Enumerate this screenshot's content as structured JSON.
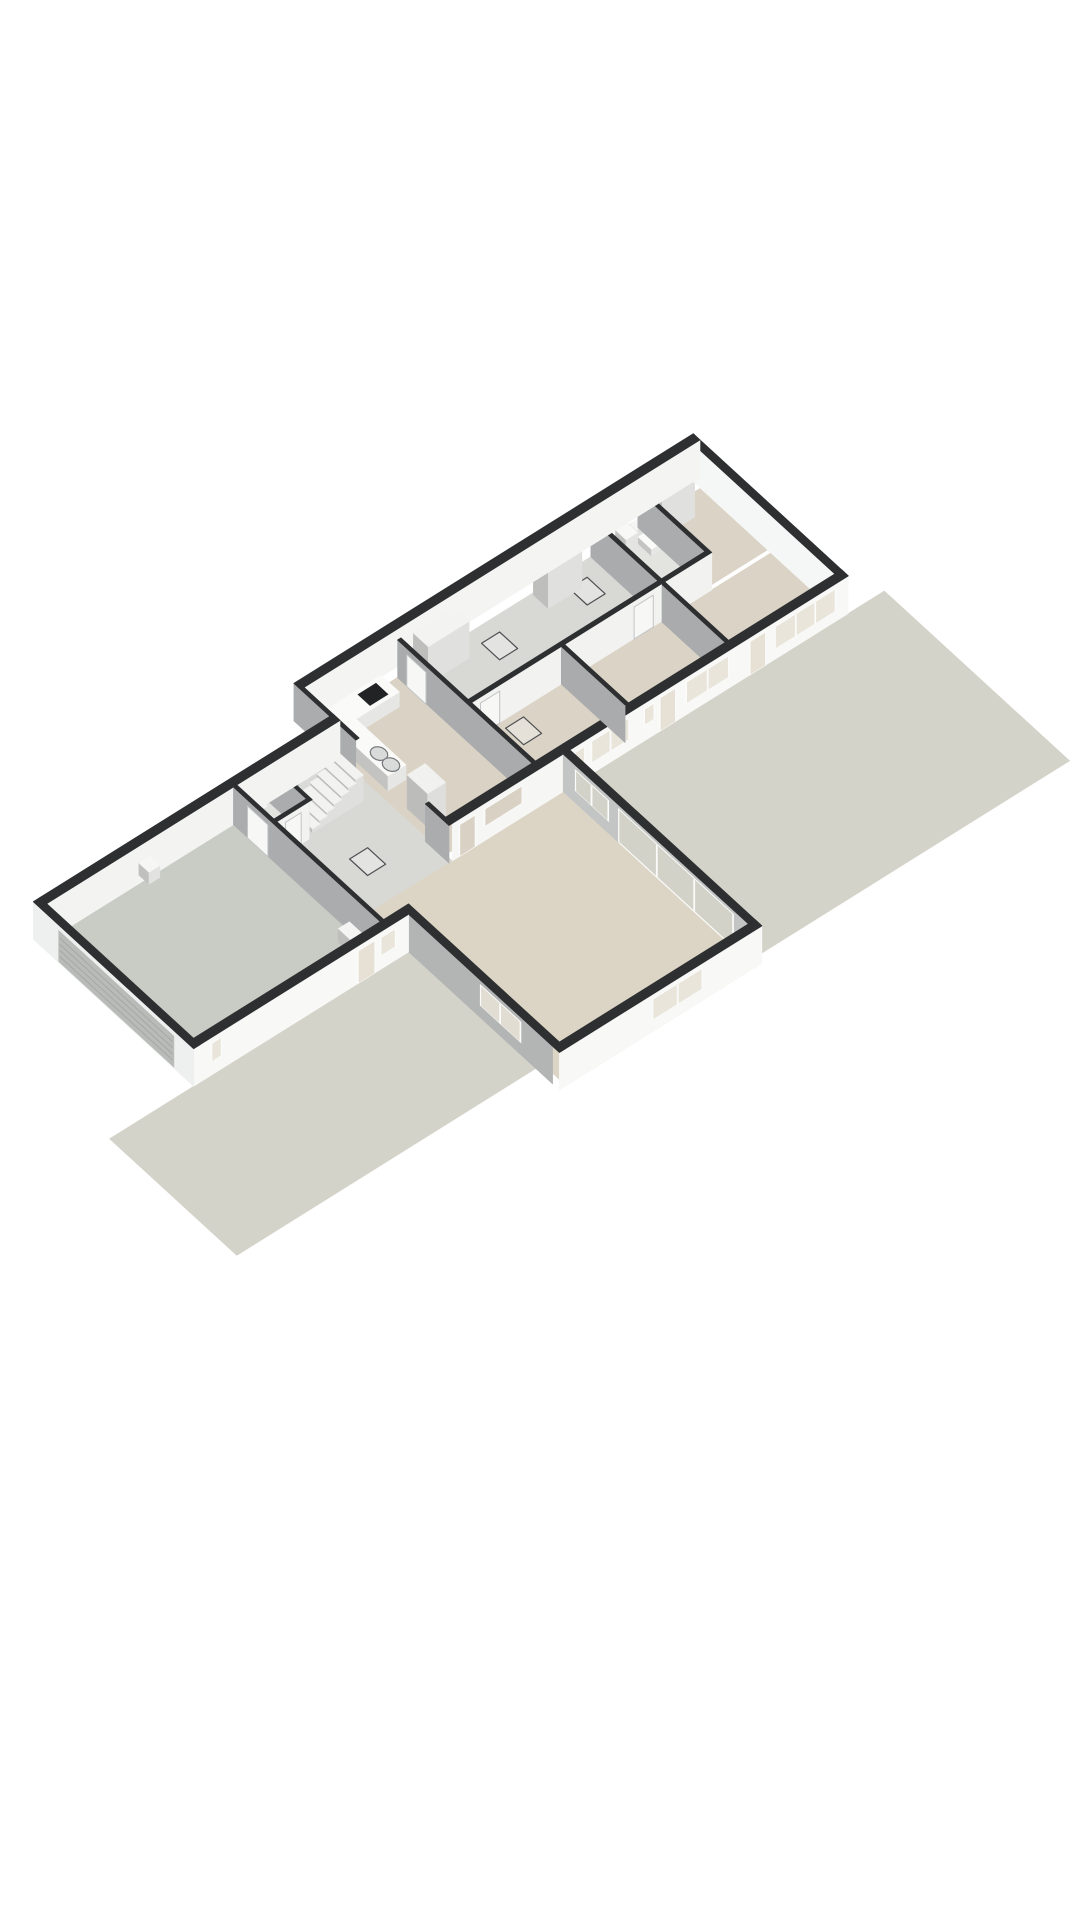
{
  "scene": {
    "projection": {
      "x0": 304,
      "y0": 725,
      "eu": [
        24,
        -15
      ],
      "ev": [
        24,
        22
      ],
      "ez": 16,
      "wall_height": 2.35
    },
    "palette": {
      "background": "#ffffff",
      "cap": "#2d2f31",
      "frame": "#fbfbfa",
      "glass_window": "#e9e5da",
      "glass_door": "#e7e0d4",
      "glass_terrace": "#d3d2c8",
      "garage_door": "#b8bbb8",
      "garage_door_line": "#a4a7a4",
      "hatch_stroke": "#4d4f52",
      "hatch_fill": "rgba(250,250,248,0.35)",
      "door_leaf": "#f7f7f6",
      "door_leaf_edge": "#c2c4c6",
      "bowl_fill": "#d9dada",
      "bowl_stroke": "#75777a"
    },
    "grounds": [
      {
        "name": "ground-terrace",
        "u1": 4.9,
        "v1": 6.18,
        "u2": 18.0,
        "v2": 13.9,
        "color": "#d4d3c9"
      },
      {
        "name": "ground-driveway",
        "u1": -16.0,
        "v1": 7.9,
        "u2": -3.54,
        "v2": 13.2,
        "color": "#d4d3c9"
      }
    ],
    "floors": [
      {
        "name": "floor-garage",
        "u1": -12.22,
        "v1": 1.5,
        "u2": -4.44,
        "v2": 7.62,
        "color": "#c9ccc5"
      },
      {
        "name": "floor-hall",
        "u1": -4.3,
        "v1": 1.5,
        "u2": 0,
        "v2": 7.62,
        "color": "#d8d8d4"
      },
      {
        "name": "floor-wc-hall",
        "u1": -4.3,
        "v1": 1.5,
        "u2": -2.95,
        "v2": 3.05,
        "color": "#e3e3df"
      },
      {
        "name": "floor-kitchen",
        "u1": 0,
        "v1": 0.3,
        "u2": 3.6,
        "v2": 5.9,
        "color": "#dad3c5"
      },
      {
        "name": "floor-corridor",
        "u1": 3.74,
        "v1": 0.3,
        "u2": 11.65,
        "v2": 3.1,
        "color": "#d8d8d4"
      },
      {
        "name": "floor-bedroom-3",
        "u1": 3.74,
        "v1": 3.24,
        "u2": 7.48,
        "v2": 5.9,
        "color": "#dbd4c6"
      },
      {
        "name": "floor-bedroom-2",
        "u1": 7.62,
        "v1": 3.24,
        "u2": 11.65,
        "v2": 5.9,
        "color": "#dbd4c6"
      },
      {
        "name": "floor-bathroom",
        "u1": 11.79,
        "v1": 0.3,
        "u2": 13.61,
        "v2": 3.1,
        "color": "#e3e3df"
      },
      {
        "name": "floor-bedroom-1-back",
        "u1": 13.75,
        "v1": 0.3,
        "u2": 16.22,
        "v2": 3.1,
        "color": "#dbd4c6"
      },
      {
        "name": "floor-bedroom-1-front",
        "u1": 11.79,
        "v1": 3.24,
        "u2": 16.22,
        "v2": 5.9,
        "color": "#dbd4c6"
      },
      {
        "name": "floor-living-room",
        "u1": -3.26,
        "v1": 6.18,
        "u2": 4.62,
        "v2": 13.9,
        "color": "#dcd5c6"
      }
    ],
    "hatches": [
      {
        "name": "floor-hatch-corridor-1",
        "u1": 6.6,
        "v1": 0.8,
        "u2": 7.35,
        "v2": 1.55
      },
      {
        "name": "floor-hatch-corridor-2",
        "u1": 10.25,
        "v1": 0.8,
        "u2": 11.0,
        "v2": 1.55
      },
      {
        "name": "floor-hatch-bedroom-3",
        "u1": 4.9,
        "v1": 3.5,
        "u2": 5.65,
        "v2": 4.25
      },
      {
        "name": "floor-hatch-hall",
        "u1": -2.5,
        "v1": 4.4,
        "u2": -1.75,
        "v2": 5.15
      }
    ],
    "walls": [
      {
        "name": "wall-main-back",
        "axis": "u",
        "u1": 0,
        "u2": 16.5,
        "v1": -0.28,
        "v2": 0,
        "face": "#f4f4f3"
      },
      {
        "name": "wall-main-end",
        "axis": "v",
        "u1": 16.22,
        "u2": 16.5,
        "v1": 0,
        "v2": 6.18,
        "face": "#f5f6f6"
      },
      {
        "name": "wall-main-front",
        "axis": "u",
        "u1": 4.9,
        "u2": 16.5,
        "v1": 5.9,
        "v2": 6.18,
        "face": "#f8f8f7",
        "openings": [
          {
            "kind": "win",
            "a1": 5.05,
            "a2": 5.5,
            "z1": 1.05,
            "z2": 2.05,
            "panes": 1
          },
          {
            "kind": "win",
            "a1": 5.75,
            "a2": 7.35,
            "z1": 0.75,
            "z2": 2.1,
            "panes": 2
          },
          {
            "kind": "win",
            "a1": 7.95,
            "a2": 8.4,
            "z1": 1.05,
            "z2": 2.05,
            "panes": 1
          },
          {
            "kind": "door",
            "a1": 8.6,
            "a2": 9.3,
            "z1": 0.05,
            "z2": 2.15,
            "panes": 1
          },
          {
            "kind": "win",
            "a1": 9.7,
            "a2": 11.5,
            "z1": 0.75,
            "z2": 2.1,
            "panes": 2
          },
          {
            "kind": "door",
            "a1": 12.35,
            "a2": 13.05,
            "z1": 0.05,
            "z2": 2.15,
            "panes": 1
          },
          {
            "kind": "win",
            "a1": 13.4,
            "a2": 15.95,
            "z1": 0.7,
            "z2": 2.1,
            "panes": 3
          }
        ]
      },
      {
        "name": "wall-kitchen-pass",
        "axis": "u",
        "u1": 0,
        "u2": 4.9,
        "v1": 5.9,
        "v2": 6.18,
        "face": "#f6f6f5",
        "openings": [
          {
            "kind": "open",
            "a1": 0.25,
            "a2": 0.95,
            "z1": 0.05,
            "z2": 2.05,
            "panes": 1,
            "glass": "#d8d1c4"
          },
          {
            "kind": "open",
            "a1": 1.3,
            "a2": 2.9,
            "z1": 0.95,
            "z2": 2.05,
            "panes": 1,
            "glass": "#d8d1c4"
          }
        ]
      },
      {
        "name": "wall-kitchen-bedroom3",
        "axis": "v",
        "u1": 3.6,
        "u2": 3.74,
        "v1": 0.3,
        "v2": 5.9,
        "face": "#a9abad"
      },
      {
        "name": "wall-corridor",
        "axis": "u",
        "u1": 3.74,
        "u2": 11.65,
        "v1": 3.1,
        "v2": 3.24,
        "face": "#f2f2f1"
      },
      {
        "name": "wall-bedroom3-bedroom2",
        "axis": "v",
        "u1": 7.48,
        "u2": 7.62,
        "v1": 3.24,
        "v2": 5.9,
        "face": "#a9abad"
      },
      {
        "name": "wall-bedroom2-bedroom1",
        "axis": "v",
        "u1": 11.65,
        "u2": 11.79,
        "v1": 0.3,
        "v2": 5.9,
        "face": "#a9abad"
      },
      {
        "name": "wall-bathroom-front",
        "axis": "u",
        "u1": 11.79,
        "u2": 13.75,
        "v1": 3.1,
        "v2": 3.24,
        "face": "#f2f2f1"
      },
      {
        "name": "wall-bathroom-bedroom1",
        "axis": "v",
        "u1": 13.61,
        "u2": 13.75,
        "v1": 0.3,
        "v2": 3.1,
        "face": "#aaacae"
      },
      {
        "name": "wall-leftwing-back",
        "axis": "u",
        "u1": -12.22,
        "u2": 0,
        "v1": 1.22,
        "v2": 1.5,
        "face": "#f3f3f2"
      },
      {
        "name": "wall-back-step",
        "axis": "v",
        "u1": -0.14,
        "u2": 0,
        "v1": -0.28,
        "v2": 1.5,
        "face": "#aaacae"
      },
      {
        "name": "wall-garage-end",
        "axis": "v",
        "u1": -12.5,
        "u2": -12.22,
        "v1": 1.22,
        "v2": 7.9,
        "face": "#eef0ef",
        "openings": [
          {
            "kind": "garage",
            "a1": 2.3,
            "a2": 7.1,
            "z1": 0.12,
            "z2": 2.05
          }
        ]
      },
      {
        "name": "wall-leftwing-front",
        "axis": "u",
        "u1": -12.5,
        "u2": -3.54,
        "v1": 7.62,
        "v2": 7.9,
        "face": "#f8f8f7",
        "openings": [
          {
            "kind": "win",
            "a1": -11.8,
            "a2": -11.35,
            "z1": 0.9,
            "z2": 2.05,
            "panes": 1
          },
          {
            "kind": "door",
            "a1": -5.7,
            "a2": -4.95,
            "z1": 0.05,
            "z2": 2.1,
            "panes": 1
          },
          {
            "kind": "win",
            "a1": -4.75,
            "a2": -4.1,
            "z1": 0.9,
            "z2": 2.05,
            "panes": 1
          }
        ]
      },
      {
        "name": "wall-garage-hall",
        "axis": "v",
        "u1": -4.44,
        "u2": -4.3,
        "v1": 1.5,
        "v2": 7.62,
        "face": "#aaacae"
      },
      {
        "name": "wall-wc-front",
        "axis": "u",
        "u1": -4.3,
        "u2": -2.95,
        "v1": 3.05,
        "v2": 3.17,
        "face": "#f2f2f1"
      },
      {
        "name": "wall-wc-side",
        "axis": "v",
        "u1": -2.95,
        "u2": -2.83,
        "v1": 1.5,
        "v2": 3.17,
        "face": "#aaacae"
      },
      {
        "name": "wall-hall-kitchen-a",
        "axis": "v",
        "u1": -0.14,
        "u2": 0,
        "v1": 1.5,
        "v2": 2.3,
        "face": "#aaacae"
      },
      {
        "name": "wall-hall-kitchen-b",
        "axis": "v",
        "u1": -0.14,
        "u2": 0,
        "v1": 5.2,
        "v2": 6.18,
        "face": "#aaacae"
      },
      {
        "name": "wall-living-left",
        "axis": "v",
        "u1": -3.54,
        "u2": -3.26,
        "v1": 7.62,
        "v2": 13.9,
        "face": "#b3b5b5",
        "openings": [
          {
            "kind": "win",
            "a1": 10.9,
            "a2": 12.6,
            "z1": 0.8,
            "z2": 2.1,
            "panes": 2,
            "glass": "#e2ddd2"
          }
        ]
      },
      {
        "name": "wall-living-front",
        "axis": "u",
        "u1": -3.54,
        "u2": 4.9,
        "v1": 13.9,
        "v2": 14.18,
        "face": "#f8f8f7",
        "openings": [
          {
            "kind": "win",
            "a1": 0.3,
            "a2": 2.4,
            "z1": 0.8,
            "z2": 2.1,
            "panes": 2
          }
        ]
      },
      {
        "name": "wall-living-right",
        "axis": "v",
        "u1": 4.62,
        "u2": 4.9,
        "v1": 6.18,
        "v2": 14.18,
        "face": "#c3c5c5",
        "openings": [
          {
            "kind": "win",
            "a1": 6.7,
            "a2": 8.1,
            "z1": 0.8,
            "z2": 2.1,
            "panes": 2,
            "glass": "#d3d2c8"
          },
          {
            "kind": "tall",
            "a1": 8.5,
            "a2": 13.3,
            "z1": 0.06,
            "z2": 2.15,
            "panes": 3,
            "glass": "#d3d2c8"
          }
        ]
      }
    ],
    "decals": [
      {
        "name": "door-leaf-garage",
        "plane": "u",
        "at": -4.455,
        "b1": 2.1,
        "b2": 2.95,
        "z1": 0,
        "z2": 2.0,
        "d": -8.98
      },
      {
        "name": "door-leaf-wc",
        "plane": "v",
        "at": 3.185,
        "b1": -3.95,
        "b2": -3.3,
        "z1": 0,
        "z2": 2.0,
        "d": -6.78
      },
      {
        "name": "door-leaf-bedroom3",
        "plane": "v",
        "at": 3.255,
        "b1": 4.1,
        "b2": 4.9,
        "z1": 0,
        "z2": 2.0,
        "d": 4.47
      },
      {
        "name": "door-leaf-bedroom2",
        "plane": "v",
        "at": 3.255,
        "b1": 10.5,
        "b2": 11.3,
        "z1": 0,
        "z2": 2.0,
        "d": 4.47
      },
      {
        "name": "door-leaf-kitchen",
        "plane": "u",
        "at": 3.585,
        "b1": 0.7,
        "b2": 1.5,
        "z1": 0,
        "z2": 2.0,
        "d": 0.52
      }
    ],
    "boxes": [
      {
        "name": "closet-corridor-1",
        "u1": 4.2,
        "v1": 0.36,
        "u2": 5.9,
        "v2": 0.98,
        "z1": 0,
        "z2": 2.3,
        "color": "#f3f3f1"
      },
      {
        "name": "closet-corridor-2",
        "u1": 9.2,
        "v1": 0.36,
        "u2": 10.6,
        "v2": 0.98,
        "z1": 0,
        "z2": 2.3,
        "color": "#f3f3f1"
      },
      {
        "name": "closet-bedroom-1",
        "u1": 13.95,
        "v1": 0.36,
        "u2": 15.3,
        "v2": 0.98,
        "z1": 0,
        "z2": 2.3,
        "color": "#f3f3f1"
      },
      {
        "name": "kitchen-counter-back",
        "u1": 0.3,
        "v1": 0.36,
        "u2": 2.85,
        "v2": 1.12,
        "z1": 0,
        "z2": 0.93,
        "color": "#fafaf8"
      },
      {
        "name": "kitchen-counter-side",
        "u1": 0.3,
        "v1": 1.12,
        "u2": 1.05,
        "v2": 3.2,
        "z1": 0,
        "z2": 0.93,
        "color": "#fafaf8"
      },
      {
        "name": "kitchen-tall-unit",
        "u1": 0.3,
        "v1": 4.0,
        "u2": 1.05,
        "v2": 4.85,
        "z1": 0,
        "z2": 2.1,
        "color": "#f1f1ef"
      },
      {
        "name": "bathtub",
        "u1": 11.85,
        "v1": 0.4,
        "u2": 12.5,
        "v2": 2.15,
        "z1": 0,
        "z2": 0.55,
        "color": "#f6f6f4"
      },
      {
        "name": "bathroom-sink",
        "u1": 12.62,
        "v1": 0.36,
        "u2": 13.1,
        "v2": 0.8,
        "z1": 0,
        "z2": 0.85,
        "color": "#f8f8f6"
      },
      {
        "name": "toilet-bowl-bathroom",
        "u1": 13.18,
        "v1": 0.74,
        "u2": 13.52,
        "v2": 1.3,
        "z1": 0,
        "z2": 0.42,
        "color": "#fbfbfa"
      },
      {
        "name": "toilet-tank-bathroom",
        "u1": 13.16,
        "v1": 0.4,
        "u2": 13.54,
        "v2": 0.68,
        "z1": 0,
        "z2": 0.78,
        "color": "#f5f5f3"
      },
      {
        "name": "toilet-bowl-hall",
        "u1": -3.82,
        "v1": 1.98,
        "u2": -3.44,
        "v2": 2.52,
        "z1": 0,
        "z2": 0.42,
        "color": "#fbfbfa"
      },
      {
        "name": "toilet-tank-hall",
        "u1": -3.84,
        "v1": 1.62,
        "u2": -3.42,
        "v2": 1.9,
        "z1": 0,
        "z2": 0.75,
        "color": "#f5f5f3"
      },
      {
        "name": "hall-cupboard",
        "u1": -2.55,
        "v1": 1.7,
        "u2": -2.1,
        "v2": 2.35,
        "z1": 0,
        "z2": 1.95,
        "color": "#ededeb"
      },
      {
        "name": "garage-boiler",
        "u1": -8.6,
        "v1": 1.72,
        "u2": -8.15,
        "v2": 2.14,
        "z1": 1.05,
        "z2": 1.8,
        "color": "#f6f6f4"
      },
      {
        "name": "garage-unit",
        "u1": -5.02,
        "v1": 6.45,
        "u2": -4.56,
        "v2": 7.05,
        "z1": 0,
        "z2": 0.85,
        "color": "#f4f4f2"
      }
    ],
    "flats": [
      {
        "name": "cooktop",
        "u1": 1.75,
        "v1": 0.5,
        "u2": 2.5,
        "v2": 1.0,
        "z": 0.95,
        "fill": "#212325"
      },
      {
        "name": "bathtub-inner",
        "u1": 11.95,
        "v1": 0.55,
        "u2": 12.4,
        "v2": 2.0,
        "z": 0.56,
        "fill": "#e9e9e6"
      }
    ],
    "bowls": [
      {
        "name": "kitchen-sink-bowl-1",
        "u": 0.675,
        "v": 2.45,
        "z": 0.95,
        "r": 0.26
      },
      {
        "name": "kitchen-sink-bowl-2",
        "u": 0.675,
        "v": 2.95,
        "z": 0.95,
        "r": 0.26
      }
    ],
    "stairs": {
      "name": "staircase",
      "u0": -2.7,
      "n": 7,
      "step": 0.3,
      "v1": 2.05,
      "v2": 3.05,
      "rise": 0.23,
      "color": "#f2f2f0"
    }
  }
}
